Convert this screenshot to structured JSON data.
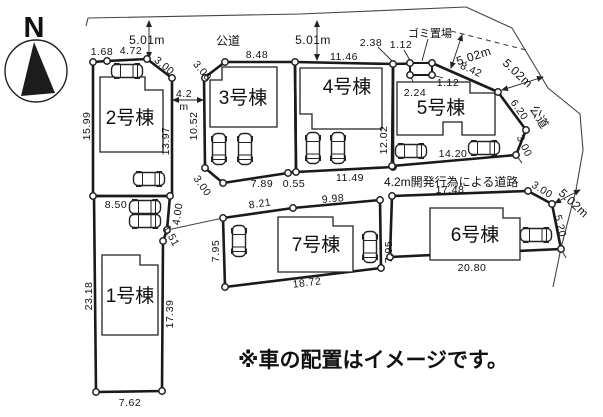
{
  "compass": {
    "label": "N"
  },
  "note": "※車の配置はイメージです。",
  "roads": {
    "public_road_top": "公道",
    "public_road_right": "公道",
    "development_road": "4.2m開発行為による道路",
    "garbage_area": "ゴミ置場",
    "width_top_left": "5.01m",
    "width_top_mid": "5.01m",
    "width_garbage": "5.02m",
    "width_right": "5.02m",
    "width_bottom_right": "5.02m",
    "width_between": "4.2",
    "width_between_unit": "m"
  },
  "lots": [
    {
      "name": "1号棟",
      "dims": {
        "top": "8.50",
        "right_upper": "4.00",
        "right_cut": "1.51",
        "right": "17.39",
        "bottom": "7.62",
        "left": "23.18"
      }
    },
    {
      "name": "2号棟",
      "dims": {
        "top_left": "1.68",
        "top": "4.72",
        "corner": "3.00",
        "left": "15.99",
        "right": "13.97"
      }
    },
    {
      "name": "3号棟",
      "dims": {
        "top": "8.48",
        "corner_top": "3.00",
        "left": "10.52",
        "corner_bottom": "3.00",
        "bottom": "7.89",
        "bottom_right": "0.55"
      }
    },
    {
      "name": "4号棟",
      "dims": {
        "top": "11.46",
        "right": "12.02",
        "bottom": "11.49",
        "offset": "2.38"
      }
    },
    {
      "name": "5号棟",
      "dims": {
        "top_diagonal": "8.42",
        "right_upper": "6.20",
        "corner": "3.00",
        "bottom": "14.20",
        "garbage_front": "1.12",
        "garbage_side": "1.12",
        "garbage_offset": "2.24"
      }
    },
    {
      "name": "6号棟",
      "dims": {
        "top": "17.48",
        "corner": "3.00",
        "right": "5.20",
        "bottom": "20.80"
      }
    },
    {
      "name": "7号棟",
      "dims": {
        "top_left": "8.21",
        "top_right": "9.98",
        "left": "7.95",
        "right": "7.95",
        "bottom": "18.72"
      }
    }
  ]
}
